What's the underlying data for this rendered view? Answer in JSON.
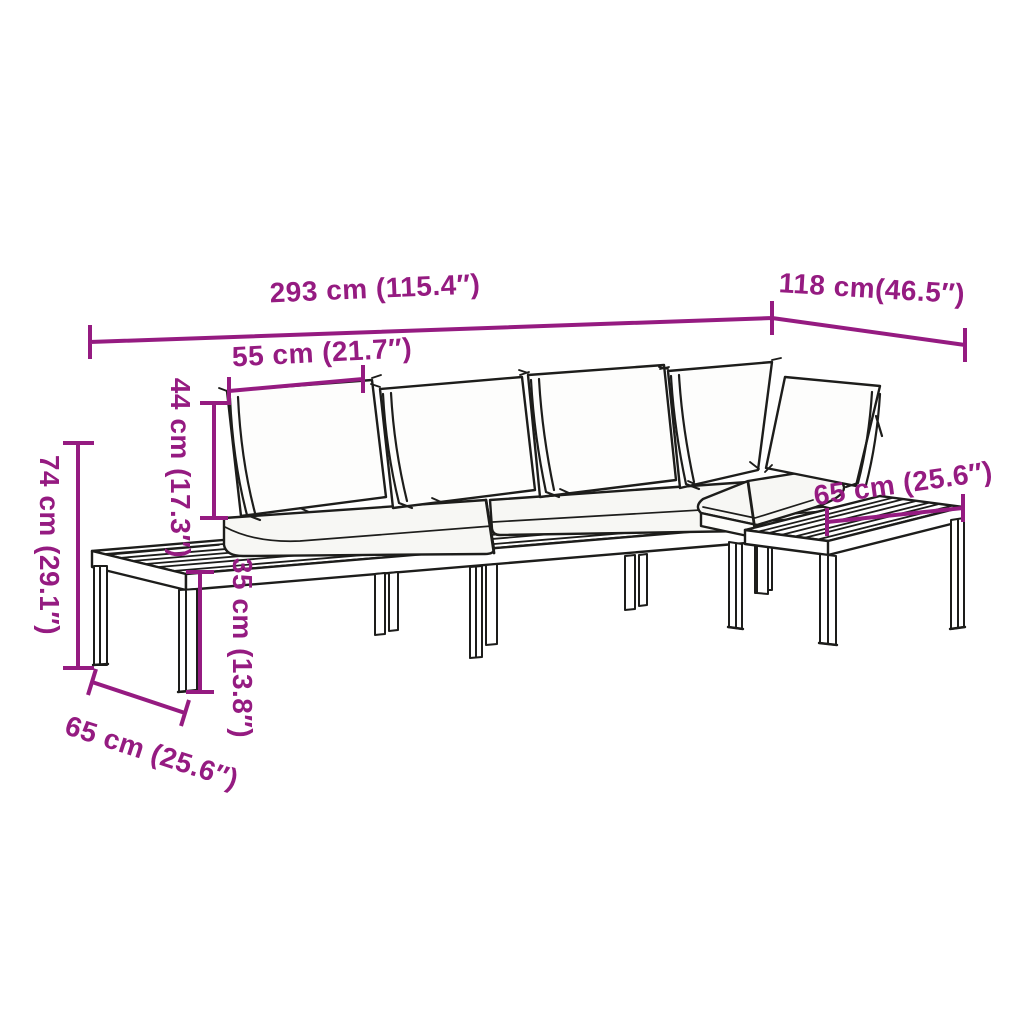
{
  "diagram": {
    "kind": "furniture-dimension-drawing",
    "background": "#ffffff",
    "accent_color": "#951b81",
    "line_color": "#1d1d1b"
  },
  "dimensions": {
    "overall_width": "293 cm (115.4″)",
    "right_depth": "118 cm(46.5″)",
    "cushion_width": "55 cm (21.7″)",
    "backrest_height": "44 cm (17.3″)",
    "total_height": "74 cm (29.1″)",
    "seat_height": "35 cm (13.8″)",
    "right_table_width": "65 cm (25.6″)",
    "left_table_depth": "65 cm (25.6″)"
  }
}
